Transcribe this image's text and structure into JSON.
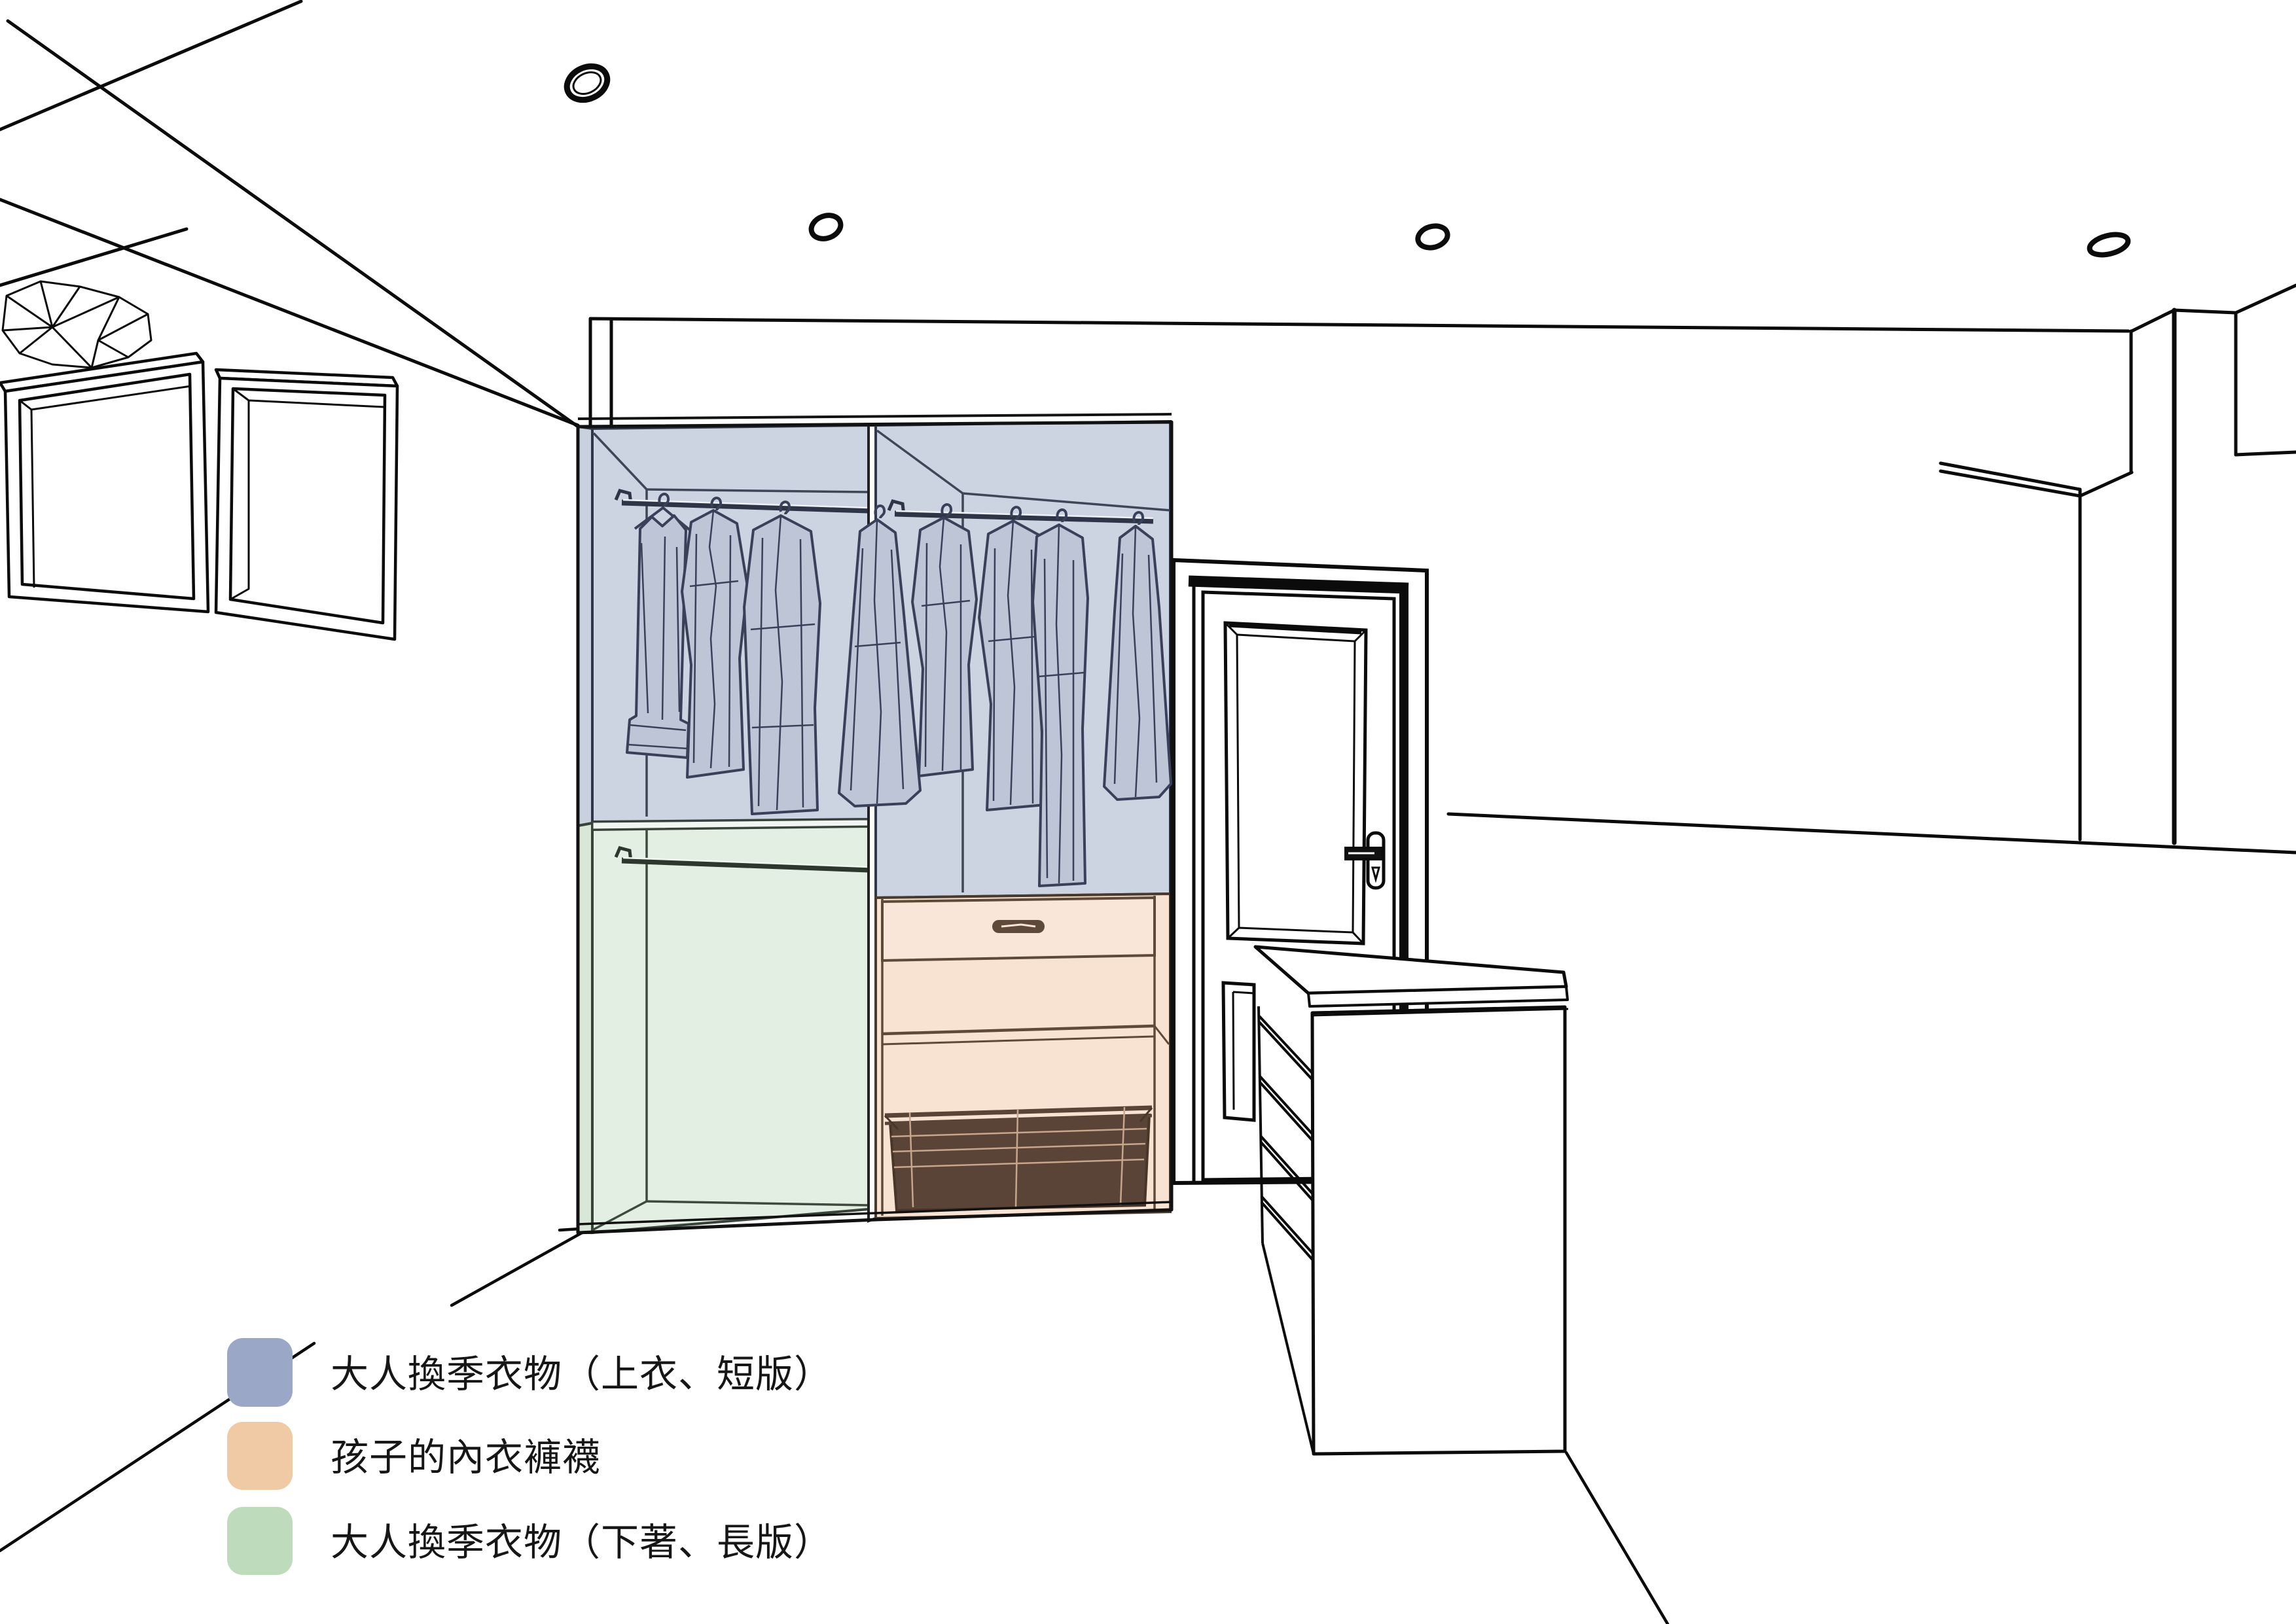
{
  "legend": {
    "items": [
      {
        "id": "adult-seasonal-tops-short",
        "label": "大人換季衣物（上衣、短版）",
        "color": "#9aa7c6"
      },
      {
        "id": "kids-underwear-socks",
        "label": " 孩子的內衣褲襪",
        "color": "#f0caa4"
      },
      {
        "id": "adult-seasonal-bottoms-long",
        "label": "大人換季衣物（下著、長版）",
        "color": "#bedcbb"
      }
    ]
  },
  "scene": {
    "type": "interior-perspective-line-drawing",
    "zones": [
      {
        "name": "adult-seasonal-tops-short-zone",
        "fill": "#ccd3e1",
        "location": "wardrobe-upper-sections",
        "hanging-garments": 8
      },
      {
        "name": "kids-underwear-socks-zone",
        "fill": "#f8e2d2",
        "location": "wardrobe-lower-right",
        "features": [
          "drawer",
          "shelf",
          "wire-basket"
        ]
      },
      {
        "name": "adult-seasonal-bottoms-long-zone",
        "fill": "#e4efe4",
        "location": "wardrobe-lower-left",
        "features": [
          "hanging-rod"
        ]
      }
    ],
    "ceiling_light_count": 4,
    "wardrobe_columns": 2,
    "furniture": [
      "wall-mounted-open-shelves",
      "two-bay-wardrobe",
      "paneled-door",
      "island-dresser-with-open-shelves",
      "half-wall"
    ]
  }
}
